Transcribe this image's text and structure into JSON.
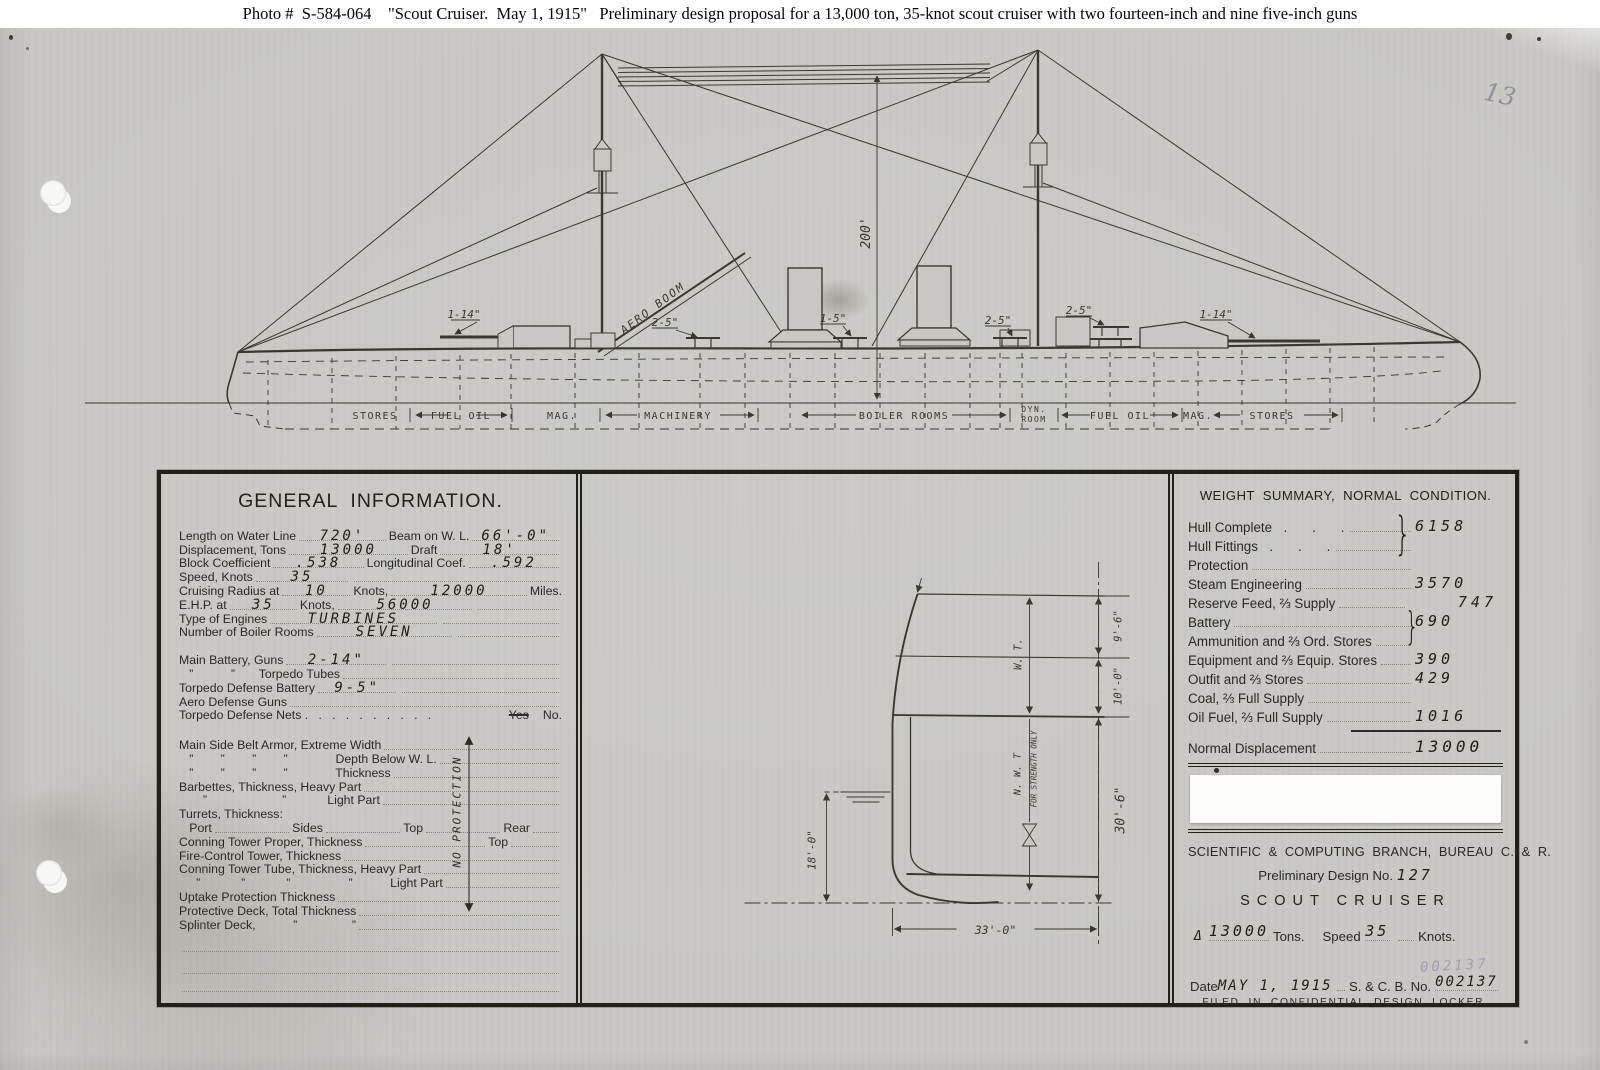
{
  "caption": "Photo #  S-584-064    \"Scout Cruiser.  May 1, 1915\"   Preliminary design proposal for a 13,000 ton, 35-knot scout cruiser with two fourteen-inch and nine five-inch guns",
  "pencil_note": "13",
  "colors": {
    "paper": "#c8c7c3",
    "ink": "#3a3833",
    "border": "#21201b",
    "stamp_ink": "#877da0"
  },
  "profile": {
    "mast_height_label": "200'",
    "aero_boom_label": "AERO BOOM",
    "gun_labels": {
      "fwd14": "1-14\"",
      "fwd5": "2-5\"",
      "mid5": "1-5\"",
      "aft5a": "2-5\"",
      "aft5b": "2-5\"",
      "aft14": "1-14\""
    },
    "compartment_labels": [
      "STORES",
      "FUEL OIL",
      "MAG.",
      "MACHINERY",
      "BOILER ROOMS",
      "DYN.",
      "ROOM",
      "FUEL OIL",
      "MAG.",
      "STORES"
    ]
  },
  "general_info": {
    "title": "GENERAL  INFORMATION.",
    "r0": {
      "l1": "Length on Water Line",
      "v1": "720'",
      "l2": "Beam on W. L.",
      "v2": "66'-0\""
    },
    "r1": {
      "l1": "Displacement, Tons",
      "v1": "13000",
      "l2": "Draft",
      "v2": "18'"
    },
    "r2": {
      "l1": "Block Coefficient",
      "v1": ".538",
      "l2": "Longitudinal Coef.",
      "v2": ".592"
    },
    "r3": {
      "l1": "Speed, Knots",
      "v1": "35"
    },
    "r4": {
      "l1": "Cruising Radius at",
      "v1": "10",
      "l2": "Knots,",
      "v2": "12000",
      "l3": "Miles."
    },
    "r5": {
      "l1": "E.H.P. at",
      "v1": "35",
      "l2": "Knots,",
      "v2": "56000"
    },
    "r6": {
      "l1": "Type of Engines",
      "v1": "TURBINES"
    },
    "r7": {
      "l1": "Number of Boiler Rooms",
      "v1": "SEVEN"
    },
    "r8": {
      "l1": "Main Battery, Guns",
      "v1": "2-14\""
    },
    "r9": {
      "l1": "   ”           ”       Torpedo Tubes"
    },
    "r10": {
      "l1": "Torpedo Defense Battery",
      "v1": "9-5\""
    },
    "r11": {
      "l1": "Aero Defense Guns"
    },
    "r12": {
      "l1": "Torpedo Defense Nets .   .   .   .   .   .   .   .   .   .",
      "yes": "Yes",
      "no": "No."
    },
    "r13": {
      "l1": "Main Side Belt Armor, Extreme Width"
    },
    "r14": {
      "l1": "   ”        ”        ”        ”              Depth Below W. L."
    },
    "r15": {
      "l1": "   ”        ”        ”        ”              Thickness"
    },
    "r16": {
      "l1": "Barbettes, Thickness, Heavy Part"
    },
    "r17": {
      "l1": "       ”                      ”            Light Part"
    },
    "r18": {
      "l1": "Turrets, Thickness:"
    },
    "r19": {
      "c1": "   Port",
      "c2": "Sides",
      "c3": "Top",
      "c4": "Rear"
    },
    "r20": {
      "l1": "Conning Tower Proper, Thickness",
      "l2": "Top"
    },
    "r21": {
      "l1": "Fire-Control Tower, Thickness"
    },
    "r22": {
      "l1": "Conning Tower Tube, Thickness, Heavy Part"
    },
    "r23": {
      "l1": "     ”            ”            ”                 ”           Light Part"
    },
    "r24": {
      "l1": "Uptake Protection Thickness"
    },
    "r25": {
      "l1": "Protective Deck, Total Thickness"
    },
    "r26": {
      "l1": "Splinter Deck,           ”                ”"
    },
    "no_protection": "NO  PROTECTION"
  },
  "section": {
    "dim_9_6": "9'-6\"",
    "dim_10_0": "10'-0\"",
    "dim_30_6": "30'-6\"",
    "dim_18_0": "18'-0\"",
    "dim_33_0": "33'-0\"",
    "wt": "W. T.",
    "nwt": "N. W. T",
    "nwt_note": "FOR STRENGTH ONLY"
  },
  "weight_summary": {
    "title": "WEIGHT  SUMMARY,  NORMAL  CONDITION.",
    "brace": "}",
    "w0": {
      "label": "Hull Complete",
      "dots": "  .    .    .",
      "value": "6158"
    },
    "w1": {
      "label": "Hull Fittings",
      "dots": "  .    .    .",
      "value": ""
    },
    "w2": {
      "label": "Protection",
      "dots": "",
      "value": ""
    },
    "w3": {
      "label": "Steam Engineering",
      "dots": "",
      "value": "3570"
    },
    "w4": {
      "label": "Reserve Feed, ⅔ Supply",
      "dots": "",
      "value": "747"
    },
    "w5": {
      "label": "Battery",
      "dots": "",
      "value": "690"
    },
    "w6": {
      "label": "Ammunition and ⅔ Ord. Stores",
      "dots": "",
      "value": ""
    },
    "w7": {
      "label": "Equipment and ⅔ Equip. Stores",
      "dots": "",
      "value": "390"
    },
    "w8": {
      "label": "Outfit and ⅔ Stores",
      "dots": "",
      "value": "429"
    },
    "w9": {
      "label": "Coal, ⅔ Full Supply",
      "dots": "",
      "value": ""
    },
    "w10": {
      "label": "Oil Fuel, ⅔ Full Supply",
      "dots": "",
      "value": "1016"
    },
    "total": {
      "label": "Normal Displacement",
      "value": "13000"
    }
  },
  "title_block": {
    "agency": "SCIENTIFIC  &  COMPUTING  BRANCH,  BUREAU  C.  &  R.",
    "design_label": "Preliminary Design No.",
    "design_no": "127",
    "ship_type": "SCOUT CRUISER",
    "delta": "Δ",
    "tons_value": "13000",
    "tons_label": "Tons.",
    "speed_label": "Speed",
    "speed_value": "35",
    "knots_label": "Knots.",
    "date_label": "Date",
    "date_value": "MAY 1, 1915",
    "scb_label": "S. & C. B. No.",
    "scb_value": "002137",
    "stamp": "002137",
    "filed": "FILED  IN  CONFIDENTIAL  DESIGN  LOCKER."
  }
}
